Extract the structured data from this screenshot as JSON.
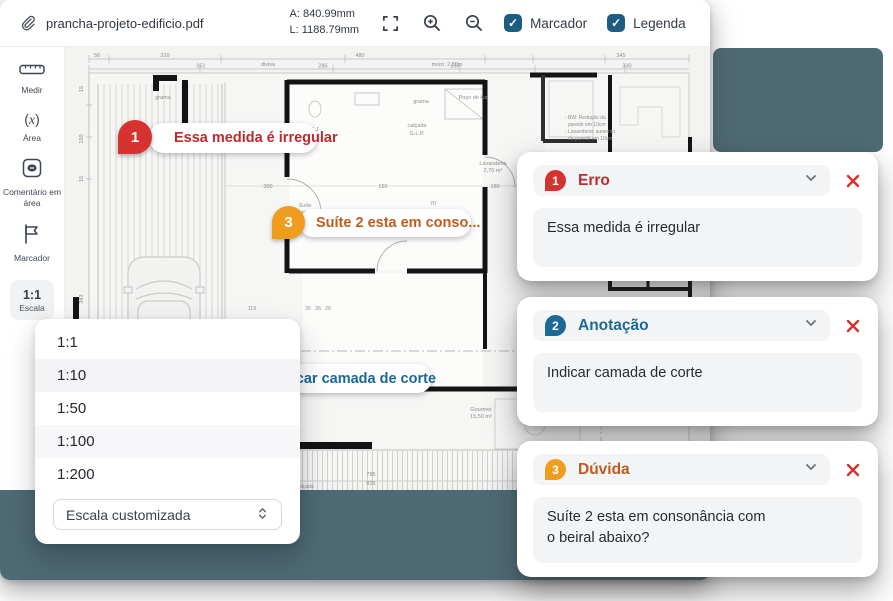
{
  "toolbar": {
    "filename": "prancha-projeto-edificio.pdf",
    "dimension_a": "A: 840.99mm",
    "dimension_l": "L: 1188.79mm",
    "checkboxes": [
      {
        "label": "Marcador",
        "checked": true,
        "check_glyph": "✓"
      },
      {
        "label": "Legenda",
        "checked": true,
        "check_glyph": "✓"
      }
    ],
    "icons": [
      "paperclip-icon",
      "fullscreen-icon",
      "zoom-in-icon",
      "zoom-out-icon"
    ],
    "checkbox_color": "#1e5d82"
  },
  "sidebar": {
    "tools": [
      {
        "label": "Medir",
        "icon": "ruler-icon"
      },
      {
        "label": "Área",
        "icon": "area-function-icon"
      },
      {
        "label": "Comentário em área",
        "icon": "comment-area-icon"
      },
      {
        "label": "Marcador",
        "icon": "flag-icon"
      },
      {
        "label": "Escala",
        "value": "1:1",
        "icon": "scale-value",
        "active": true
      }
    ]
  },
  "scale_dropdown": {
    "options": [
      "1:1",
      "1:10",
      "1:50",
      "1:100",
      "1:200"
    ],
    "highlighted": "1:10",
    "custom_placeholder": "Escala customizada",
    "updown_icon": "chevron-updown-icon"
  },
  "markers": [
    {
      "number": "1",
      "label": "Essa medida é irregular",
      "color": "#d63230",
      "text_color": "#c0282e"
    },
    {
      "number": "2",
      "label": "Indicar camada de corte",
      "color": "#1b6a95",
      "text_color": "#1b6795"
    },
    {
      "number": "3",
      "label": "Suíte 2 esta em conso...",
      "color": "#f09c1e",
      "text_color": "#c05b20"
    }
  ],
  "annotations": {
    "cards": [
      {
        "number": "1",
        "title": "Erro",
        "body": "Essa medida é irregular",
        "accent": "#c22a30",
        "badge": "#d63230"
      },
      {
        "number": "2",
        "title": "Anotação",
        "body": "Indicar camada de corte",
        "accent": "#1b6a95",
        "badge": "#1b6a95"
      },
      {
        "number": "3",
        "title": "Dúvida",
        "body": "Suíte 2 esta em consonância com\no beiral abaixo?",
        "accent": "#c25b1e",
        "badge": "#f09c1e"
      }
    ],
    "close_color": "#df2c2c"
  },
  "plan": {
    "pool_color": "#4e6a75",
    "texts": [
      {
        "t": "grama",
        "x": 98,
        "y": 52
      },
      {
        "t": "grama",
        "x": 356,
        "y": 56
      },
      {
        "t": "divisa",
        "x": 203,
        "y": 19
      },
      {
        "t": "muro: 2,50m",
        "x": 382,
        "y": 19
      },
      {
        "t": "Poço de luz",
        "x": 408,
        "y": 52
      },
      {
        "t": "BWC J",
        "x": 245,
        "y": 84
      },
      {
        "t": "4,28 m²",
        "x": 245,
        "y": 91
      },
      {
        "t": "Suíte",
        "x": 240,
        "y": 160
      },
      {
        "t": "Jurema",
        "x": 240,
        "y": 167
      },
      {
        "t": "12,61 m²",
        "x": 240,
        "y": 174
      },
      {
        "t": "calçada",
        "x": 352,
        "y": 80
      },
      {
        "t": "G.L.P.",
        "x": 352,
        "y": 88
      },
      {
        "t": "Lavanderia",
        "x": 428,
        "y": 118
      },
      {
        "t": "2,70 m²",
        "x": 428,
        "y": 125
      },
      {
        "t": "BW",
        "x": 530,
        "y": 120
      },
      {
        "t": "3,35 m²",
        "x": 530,
        "y": 127
      },
      {
        "t": "- BW: Redução da",
        "x": 500,
        "y": 72,
        "a": "start",
        "s": 5
      },
      {
        "t": "parede em 10cm",
        "x": 503,
        "y": 79,
        "a": "start",
        "s": 5
      },
      {
        "t": "- Lavanderia: aumento",
        "x": 500,
        "y": 86,
        "a": "start",
        "s": 5
      },
      {
        "t": "da parede em 10cm",
        "x": 503,
        "y": 93,
        "a": "start",
        "s": 5
      },
      {
        "t": "Gourmet",
        "x": 416,
        "y": 364
      },
      {
        "t": "15,50 m²",
        "x": 416,
        "y": 371
      },
      {
        "t": "calçada",
        "x": 240,
        "y": 441,
        "s": 5
      },
      {
        "t": "56",
        "x": 32,
        "y": 10
      },
      {
        "t": "310",
        "x": 100,
        "y": 10
      },
      {
        "t": "480",
        "x": 295,
        "y": 10
      },
      {
        "t": "345",
        "x": 556,
        "y": 10
      },
      {
        "t": "351",
        "x": 136,
        "y": 20.5
      },
      {
        "t": "285",
        "x": 258,
        "y": 20.5
      },
      {
        "t": "150",
        "x": 390,
        "y": 20.5
      },
      {
        "t": "330",
        "x": 562,
        "y": 20.5
      },
      {
        "t": "15",
        "x": 18,
        "y": 42,
        "r": -90
      },
      {
        "t": "150",
        "x": 18,
        "y": 92,
        "r": -90
      },
      {
        "t": "15",
        "x": 18,
        "y": 132,
        "r": -90
      },
      {
        "t": "343",
        "x": 18,
        "y": 252,
        "r": -90
      },
      {
        "t": "935",
        "x": 18,
        "y": 392,
        "r": -90
      },
      {
        "t": "300",
        "x": 203,
        "y": 141
      },
      {
        "t": "150",
        "x": 318,
        "y": 141
      },
      {
        "t": "180",
        "x": 430,
        "y": 141
      },
      {
        "t": "135",
        "x": 472,
        "y": 141
      },
      {
        "t": "70",
        "x": 368,
        "y": 158
      },
      {
        "t": "115",
        "x": 187,
        "y": 263
      },
      {
        "t": "26",
        "x": 243,
        "y": 263
      },
      {
        "t": "26",
        "x": 253,
        "y": 263
      },
      {
        "t": "26",
        "x": 263,
        "y": 263
      },
      {
        "t": "785",
        "x": 306,
        "y": 429
      },
      {
        "t": "825",
        "x": 306,
        "y": 438
      },
      {
        "t": "110",
        "x": 540,
        "y": 415
      }
    ]
  }
}
